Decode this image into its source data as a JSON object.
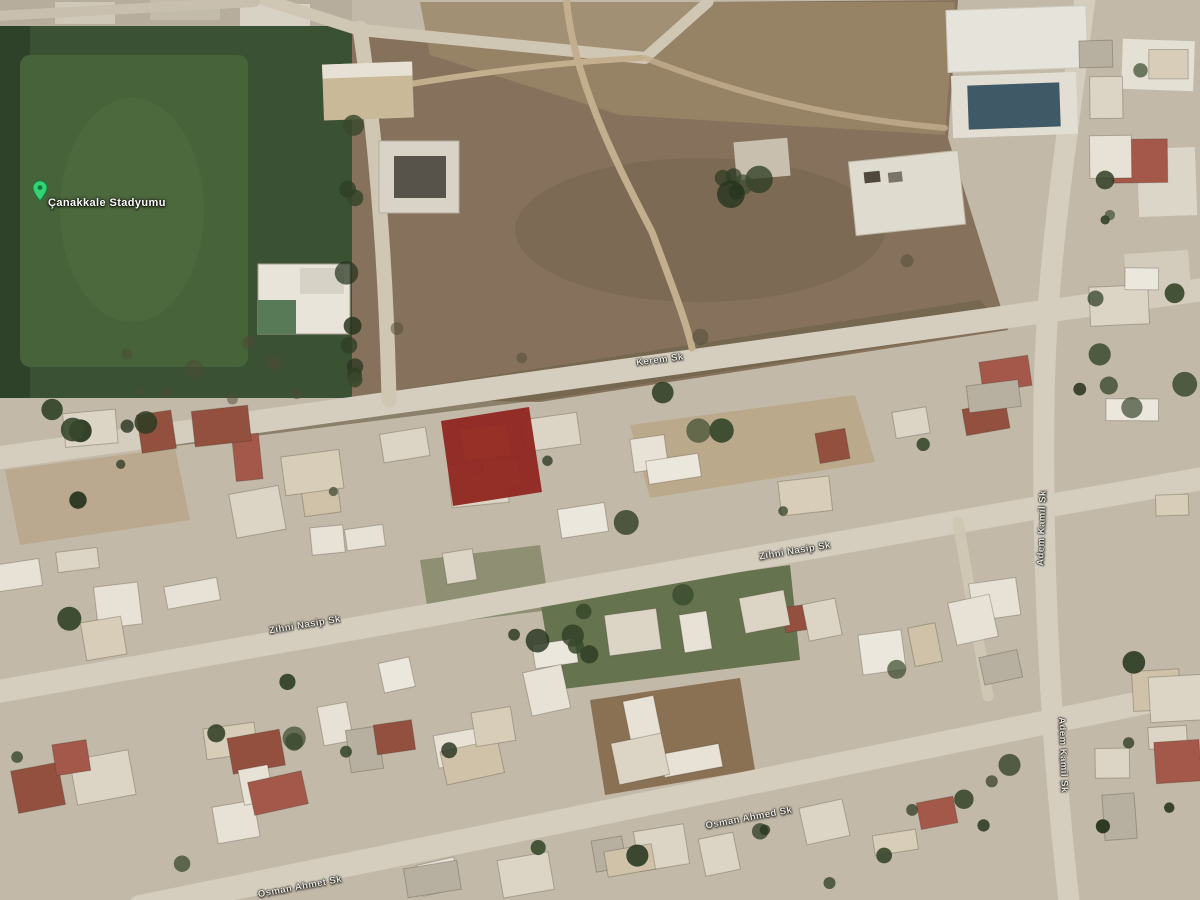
{
  "map": {
    "title": "satellite-map-view",
    "place_label": {
      "text": "Çanakkale Stadyumu"
    },
    "pin": {
      "name": "stadium-pin",
      "color": "#35d173",
      "border": "#0e7a41"
    },
    "street_labels": [
      {
        "text": "Kerem Sk",
        "x": 660,
        "y": 360,
        "rot": -7.5
      },
      {
        "text": "Zihni Nasip Sk",
        "x": 305,
        "y": 625,
        "rot": -9.5
      },
      {
        "text": "Zihni Nasip Sk",
        "x": 795,
        "y": 551,
        "rot": -9.5
      },
      {
        "text": "Osman Ahmed Sk",
        "x": 749,
        "y": 818,
        "rot": -10.5
      },
      {
        "text": "Osman Ahmet Sk",
        "x": 300,
        "y": 887,
        "rot": -10.5
      },
      {
        "text": "Adem Kamil Sk",
        "x": 1042,
        "y": 528,
        "rot": -88
      },
      {
        "text": "Adem Kamil Sk",
        "x": 1063,
        "y": 755,
        "rot": 88
      }
    ],
    "highlight_parcel": {
      "color": "#8f2620",
      "opacity": 0.95
    }
  },
  "theme": {
    "base": "#c3b9a8",
    "road": "#d5cdbe",
    "dirt_field": "#86725c",
    "stadium_green": "#3a5233",
    "pitch_green": "#466339",
    "tree_green": "#2e3d24",
    "building_white": "#e7e2d5",
    "roof_red": "#a3584a",
    "solar_blue": "#3f5a66"
  }
}
